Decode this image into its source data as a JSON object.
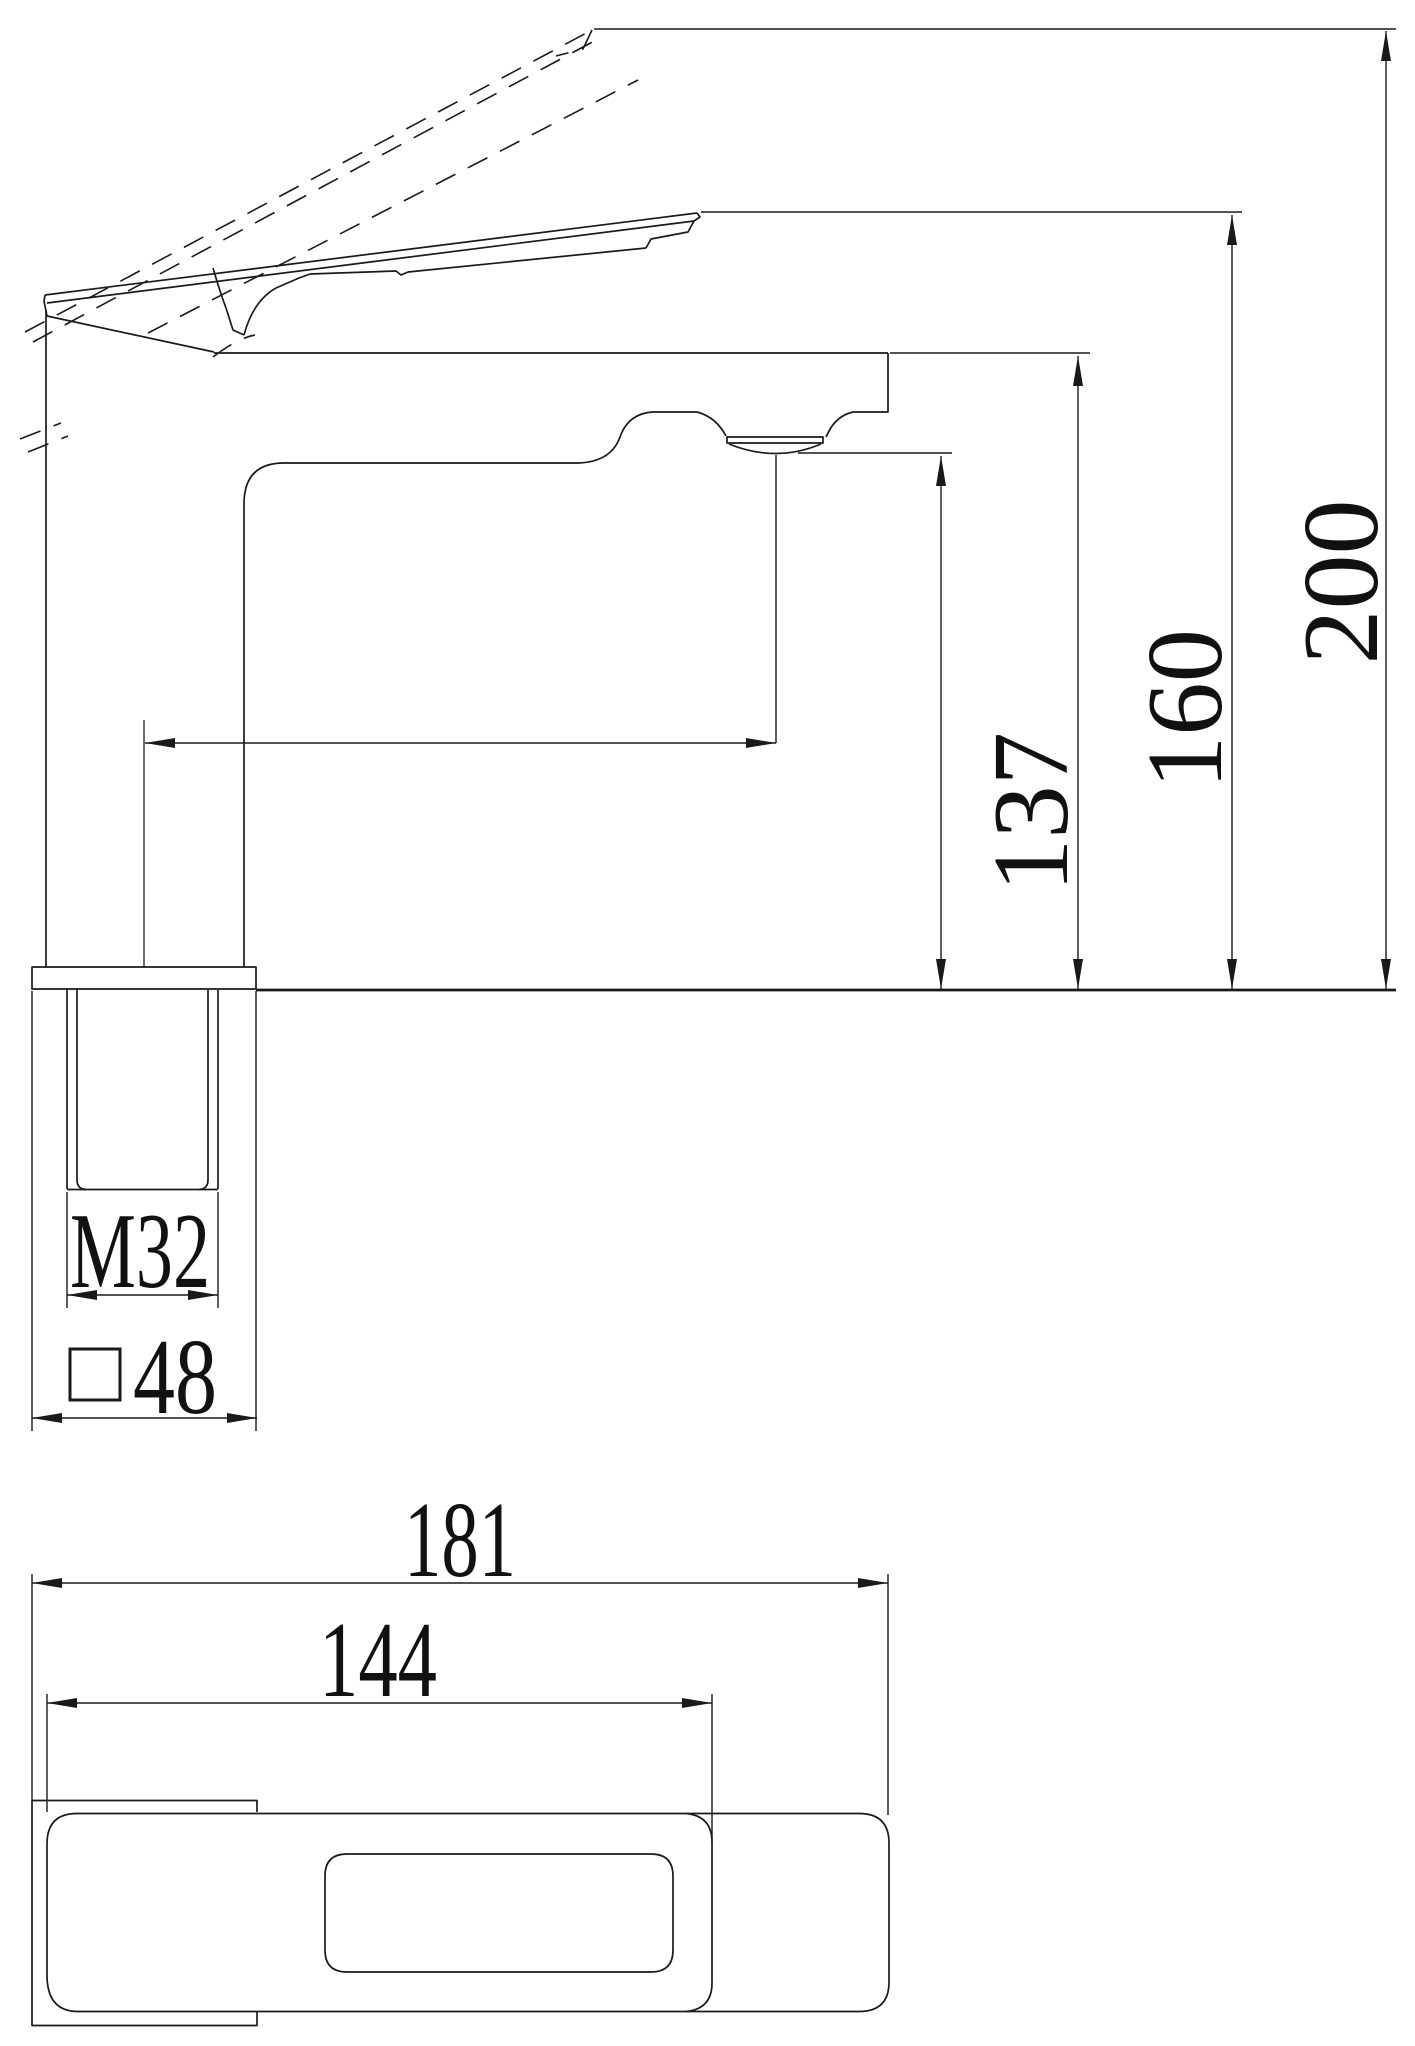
{
  "drawing": {
    "type": "technical-dimension-drawing",
    "subject": "single-lever basin faucet, side view and bottom view",
    "views": {
      "side": {
        "height_to_spout_top": "137",
        "height_to_handle_top": "160",
        "height_handle_open": "200",
        "shank_thread": "M32",
        "base_square_size": "48"
      },
      "bottom": {
        "overall_length": "181",
        "length_to_handle_tip": "144"
      }
    },
    "colors": {
      "line": "#1a1a1a",
      "background": "#ffffff"
    }
  }
}
